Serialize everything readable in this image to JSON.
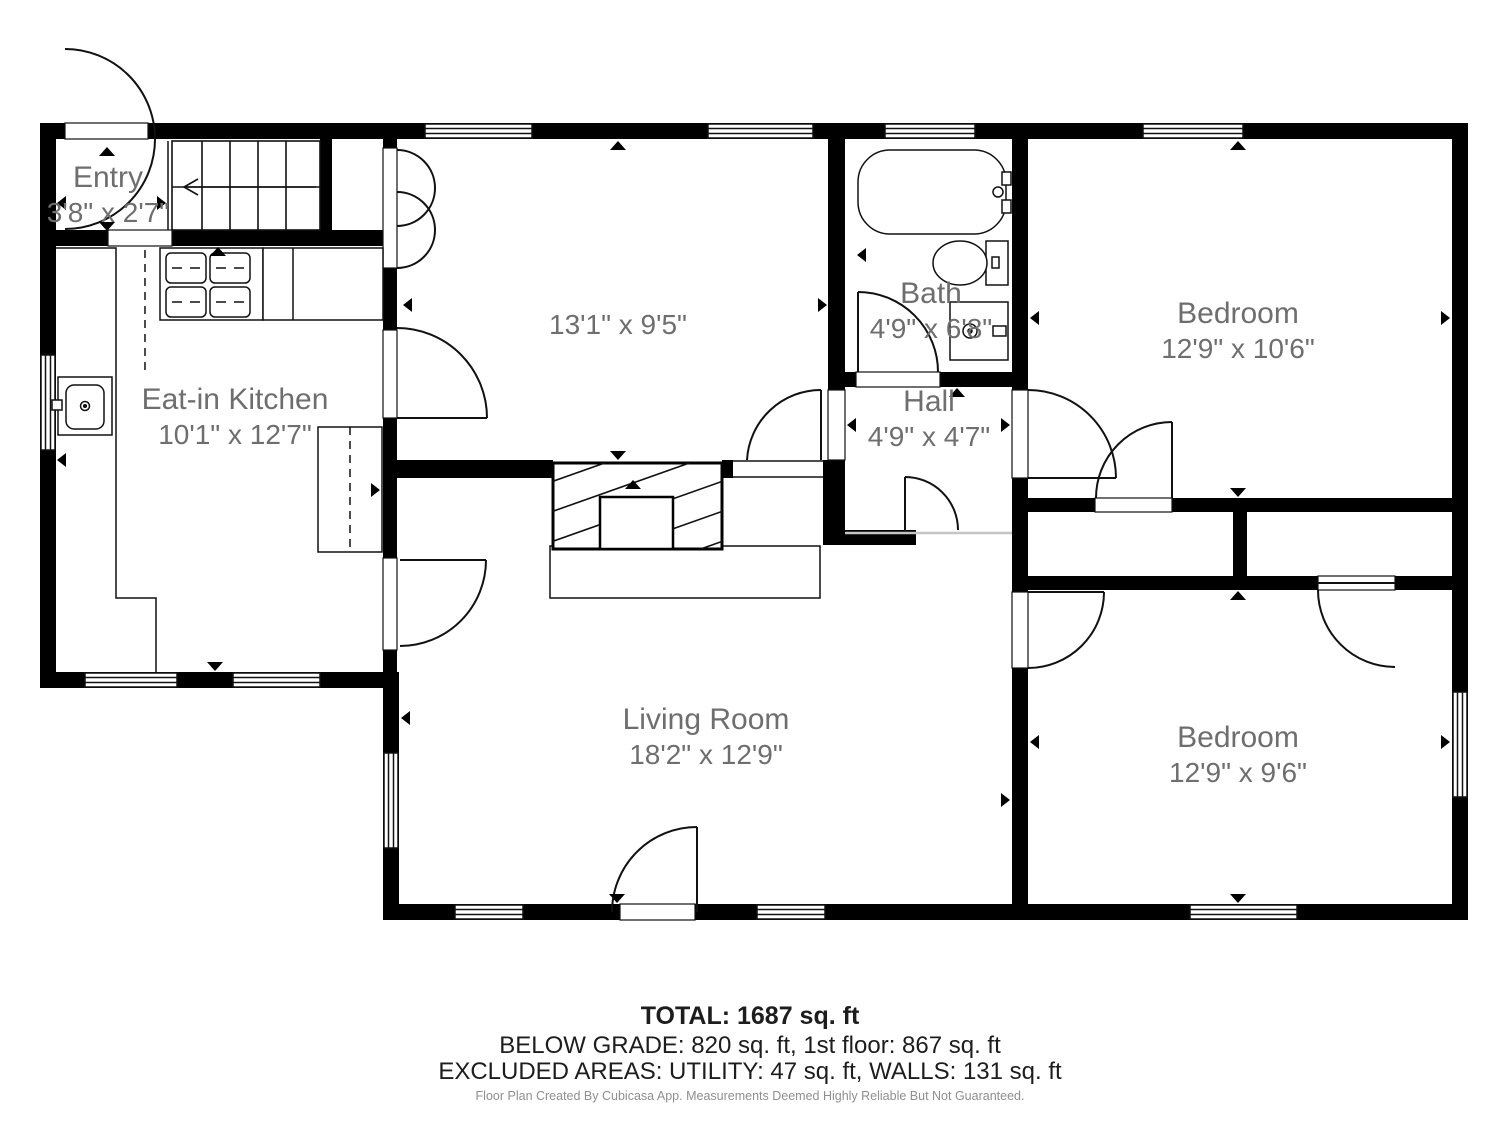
{
  "rooms": {
    "entry": {
      "name": "Entry",
      "dims": "3'8\" x 2'7\""
    },
    "kitchen": {
      "name": "Eat-in Kitchen",
      "dims": "10'1\" x 12'7\""
    },
    "dining": {
      "name": "",
      "dims": "13'1\" x 9'5\""
    },
    "bath": {
      "name": "Bath",
      "dims": "4'9\" x 6'8\""
    },
    "hall": {
      "name": "Hall",
      "dims": "4'9\" x 4'7\""
    },
    "bedroom_top": {
      "name": "Bedroom",
      "dims": "12'9\" x 10'6\""
    },
    "bedroom_bottom": {
      "name": "Bedroom",
      "dims": "12'9\" x 9'6\""
    },
    "living": {
      "name": "Living Room",
      "dims": "18'2\" x 12'9\""
    }
  },
  "footer": {
    "total": "TOTAL: 1687 sq. ft",
    "line2": "BELOW GRADE: 820 sq. ft, 1st floor: 867 sq. ft",
    "line3": "EXCLUDED AREAS: UTILITY: 47 sq. ft, WALLS: 131 sq. ft",
    "disclaimer": "Floor Plan Created By Cubicasa App. Measurements Deemed Highly Reliable But Not Guaranteed."
  },
  "colors": {
    "wall": "#000000",
    "label_text": "#6e6e6e",
    "footer_text": "#1d1d1d",
    "disclaimer_text": "#8f8f8f",
    "separator": "#c5c5c5"
  }
}
